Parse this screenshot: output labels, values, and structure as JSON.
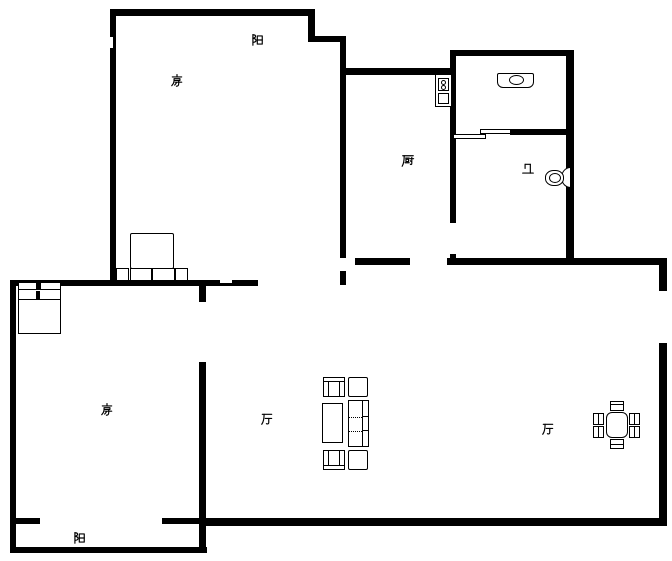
{
  "canvas": {
    "width": 672,
    "height": 561,
    "background": "#ffffff",
    "wall_color": "#000000"
  },
  "plan_type": "apartment-floor-plan",
  "rooms": [
    {
      "id": "balcony-top",
      "label": "阳",
      "meaning": "balcony"
    },
    {
      "id": "bedroom-top",
      "label": "房",
      "meaning": "bedroom"
    },
    {
      "id": "kitchen",
      "label": "厨",
      "meaning": "kitchen"
    },
    {
      "id": "bathroom",
      "label": "卫",
      "meaning": "bathroom"
    },
    {
      "id": "bedroom-bottom",
      "label": "房",
      "meaning": "bedroom"
    },
    {
      "id": "living-room",
      "label": "厅",
      "meaning": "living room"
    },
    {
      "id": "dining-room",
      "label": "厅",
      "meaning": "dining room"
    },
    {
      "id": "balcony-bottom",
      "label": "阳",
      "meaning": "balcony"
    }
  ],
  "fixtures": [
    "double-bed-with-nightstands",
    "single-bed",
    "stove",
    "wash-basin",
    "toilet",
    "sofa",
    "armchair",
    "armchair",
    "side-table",
    "side-table",
    "coffee-table",
    "dining-table",
    "dining-chair-x6",
    "sliding-door"
  ]
}
